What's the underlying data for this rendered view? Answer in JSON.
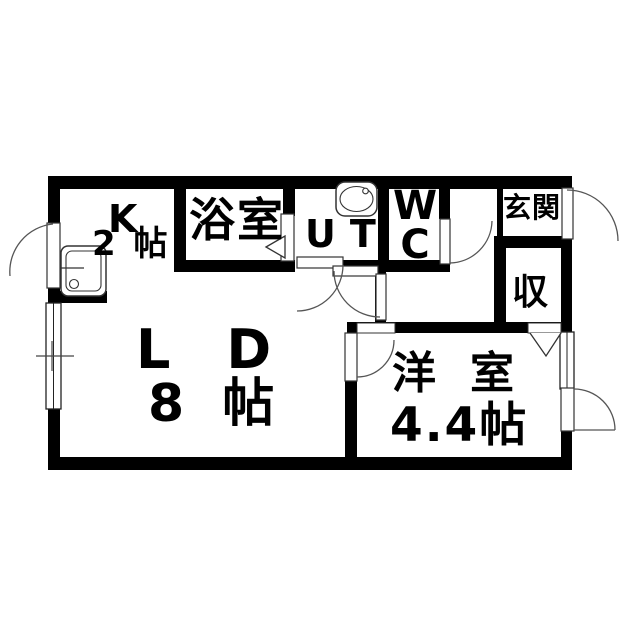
{
  "floorplan": {
    "rooms": {
      "kitchen": {
        "name": "K",
        "size": "2 帖"
      },
      "bathroom": {
        "name": "浴室"
      },
      "utility": {
        "name": "UT"
      },
      "toilet": {
        "line1": "W",
        "line2": "C"
      },
      "entrance": {
        "name": "玄関"
      },
      "storage": {
        "name": "収"
      },
      "living_dining": {
        "name": "LD",
        "size": "8 帖"
      },
      "western_room": {
        "name": "洋室",
        "size": "4.4帖"
      }
    },
    "colors": {
      "wall": "#000000",
      "background": "#ffffff",
      "line": "#555555"
    }
  }
}
